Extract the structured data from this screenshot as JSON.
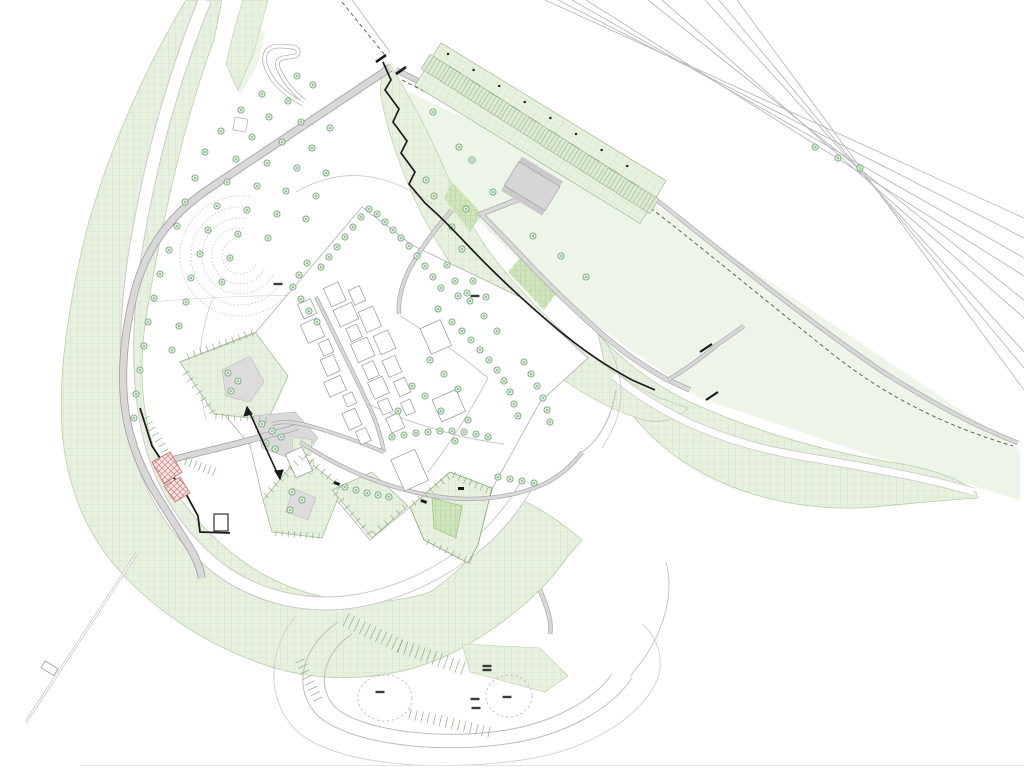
{
  "palette": {
    "band_fill": "#e8f1e0",
    "band_line": "#c7ddb4",
    "band_dense": "#cfe5bc",
    "band_dense_line": "#a2c98b",
    "flat_green": "#edf5e8",
    "road_fill": "#d8d8d8",
    "road_edge": "#9f9f9f",
    "rail_line": "#b9b9b9",
    "tree_stroke": "#6da377",
    "tree_fill": "#ddeed7",
    "tree_dot": "#4e8b5a",
    "wall_black": "#1c1c1c",
    "red_hatch": "#d08080",
    "label_ink": "#3a3a3a",
    "stall_fill": "#dcead2",
    "stall_line": "#8fb491"
  },
  "trees": [
    [
      297,
      76
    ],
    [
      313,
      85
    ],
    [
      262,
      94
    ],
    [
      288,
      101
    ],
    [
      241,
      110
    ],
    [
      269,
      117
    ],
    [
      301,
      122
    ],
    [
      330,
      128
    ],
    [
      221,
      131
    ],
    [
      252,
      137
    ],
    [
      282,
      142
    ],
    [
      312,
      148
    ],
    [
      205,
      152
    ],
    [
      236,
      159
    ],
    [
      267,
      163
    ],
    [
      297,
      168
    ],
    [
      326,
      173
    ],
    [
      195,
      178
    ],
    [
      227,
      182
    ],
    [
      257,
      186
    ],
    [
      286,
      191
    ],
    [
      316,
      196
    ],
    [
      185,
      202
    ],
    [
      217,
      206
    ],
    [
      247,
      210
    ],
    [
      277,
      214
    ],
    [
      306,
      219
    ],
    [
      177,
      226
    ],
    [
      208,
      230
    ],
    [
      238,
      234
    ],
    [
      268,
      238
    ],
    [
      169,
      250
    ],
    [
      200,
      254
    ],
    [
      230,
      258
    ],
    [
      160,
      274
    ],
    [
      191,
      278
    ],
    [
      222,
      282
    ],
    [
      154,
      298
    ],
    [
      186,
      302
    ],
    [
      148,
      322
    ],
    [
      179,
      326
    ],
    [
      144,
      346
    ],
    [
      172,
      350
    ],
    [
      140,
      370
    ],
    [
      136,
      394
    ],
    [
      134,
      418
    ],
    [
      321,
      267
    ],
    [
      329,
      257
    ],
    [
      337,
      247
    ],
    [
      345,
      237
    ],
    [
      353,
      227
    ],
    [
      361,
      217
    ],
    [
      369,
      209
    ],
    [
      377,
      214
    ],
    [
      385,
      222
    ],
    [
      393,
      230
    ],
    [
      401,
      238
    ],
    [
      409,
      246
    ],
    [
      417,
      256
    ],
    [
      425,
      266
    ],
    [
      433,
      277
    ],
    [
      441,
      288
    ],
    [
      307,
      263
    ],
    [
      299,
      275
    ],
    [
      293,
      287
    ],
    [
      301,
      299
    ],
    [
      309,
      311
    ],
    [
      317,
      322
    ],
    [
      472,
      160
    ],
    [
      493,
      192
    ],
    [
      466,
      209
    ],
    [
      452,
      227
    ],
    [
      462,
      249
    ],
    [
      447,
      265
    ],
    [
      473,
      281
    ],
    [
      486,
      297
    ],
    [
      458,
      296
    ],
    [
      438,
      309
    ],
    [
      426,
      180
    ],
    [
      434,
      196
    ],
    [
      452,
      322
    ],
    [
      462,
      331
    ],
    [
      471,
      340
    ],
    [
      480,
      350
    ],
    [
      489,
      360
    ],
    [
      497,
      370
    ],
    [
      504,
      381
    ],
    [
      510,
      392
    ],
    [
      514,
      404
    ],
    [
      518,
      416
    ],
    [
      524,
      362
    ],
    [
      531,
      374
    ],
    [
      537,
      386
    ],
    [
      543,
      398
    ],
    [
      547,
      410
    ],
    [
      550,
      422
    ],
    [
      392,
      437
    ],
    [
      404,
      435
    ],
    [
      416,
      433
    ],
    [
      428,
      432
    ],
    [
      440,
      431
    ],
    [
      452,
      431
    ],
    [
      464,
      432
    ],
    [
      476,
      434
    ],
    [
      488,
      437
    ],
    [
      345,
      487
    ],
    [
      356,
      490
    ],
    [
      367,
      493
    ],
    [
      378,
      495
    ],
    [
      389,
      497
    ],
    [
      498,
      477
    ],
    [
      510,
      479
    ],
    [
      522,
      481
    ],
    [
      534,
      483
    ],
    [
      430,
      360
    ],
    [
      444,
      374
    ],
    [
      458,
      389
    ],
    [
      425,
      396
    ],
    [
      441,
      411
    ],
    [
      468,
      420
    ],
    [
      455,
      441
    ],
    [
      412,
      386
    ],
    [
      398,
      411
    ],
    [
      470,
      301
    ],
    [
      484,
      316
    ],
    [
      497,
      331
    ],
    [
      455,
      281
    ],
    [
      467,
      293
    ],
    [
      533,
      236
    ],
    [
      561,
      256
    ],
    [
      586,
      277
    ],
    [
      815,
      147
    ],
    [
      838,
      158
    ],
    [
      860,
      168
    ],
    [
      262,
      424
    ],
    [
      272,
      431
    ],
    [
      281,
      437
    ],
    [
      266,
      443
    ],
    [
      275,
      449
    ],
    [
      228,
      373
    ],
    [
      238,
      381
    ],
    [
      231,
      391
    ],
    [
      292,
      492
    ],
    [
      302,
      500
    ],
    [
      290,
      510
    ],
    [
      433,
      112
    ],
    [
      459,
      147
    ]
  ],
  "parking_lot": {
    "bay_count": 11,
    "origin": [
      441,
      71
    ],
    "step": [
      19.8,
      12.6
    ],
    "bay_w": 36,
    "bay_h": 17,
    "angle": 31.5,
    "stalls_per_bay": 8,
    "post_count": 8,
    "post_origin": [
      448,
      54
    ],
    "post_step": [
      25.6,
      16
    ]
  },
  "buildings": {
    "cx": 350,
    "cy": 373,
    "angle": 66,
    "rects": [
      [
        -88,
        -26,
        20,
        16
      ],
      [
        -64,
        -30,
        18,
        20
      ],
      [
        -42,
        -26,
        14,
        12
      ],
      [
        -26,
        -30,
        20,
        18
      ],
      [
        -2,
        -26,
        16,
        12
      ],
      [
        16,
        -28,
        18,
        16
      ],
      [
        38,
        -24,
        14,
        11
      ],
      [
        56,
        -28,
        16,
        14
      ],
      [
        -84,
        6,
        16,
        14
      ],
      [
        -64,
        8,
        20,
        18
      ],
      [
        -40,
        6,
        14,
        11
      ],
      [
        -24,
        8,
        18,
        14
      ],
      [
        -2,
        10,
        16,
        18
      ],
      [
        18,
        6,
        12,
        10
      ],
      [
        34,
        10,
        18,
        14
      ],
      [
        56,
        8,
        14,
        11
      ],
      [
        -52,
        -48,
        22,
        16
      ],
      [
        -24,
        -52,
        20,
        16
      ],
      [
        2,
        -48,
        18,
        14
      ],
      [
        -76,
        -44,
        16,
        12
      ],
      [
        26,
        -48,
        16,
        12
      ],
      [
        48,
        -44,
        14,
        10
      ],
      [
        -12,
        -104,
        28,
        22
      ],
      [
        58,
        -90,
        24,
        26
      ],
      [
        96,
        -28,
        34,
        26
      ],
      [
        48,
        74,
        26,
        18
      ]
    ]
  },
  "tick_rows": [
    [
      188,
      356,
      252,
      333,
      7,
      10
    ],
    [
      186,
      373,
      212,
      412,
      7,
      6
    ],
    [
      216,
      416,
      266,
      420,
      6,
      8
    ],
    [
      266,
      495,
      301,
      458,
      7,
      7
    ],
    [
      306,
      456,
      340,
      487,
      7,
      6
    ],
    [
      276,
      533,
      319,
      536,
      6,
      7
    ],
    [
      336,
      494,
      369,
      533,
      6,
      6
    ],
    [
      374,
      533,
      404,
      507,
      6,
      5
    ],
    [
      414,
      503,
      448,
      477,
      7,
      6
    ],
    [
      454,
      475,
      487,
      490,
      7,
      6
    ],
    [
      428,
      542,
      465,
      559,
      6,
      6
    ],
    [
      146,
      418,
      168,
      456,
      8,
      7
    ],
    [
      186,
      461,
      214,
      472,
      9,
      6
    ],
    [
      346,
      620,
      400,
      646,
      14,
      10
    ],
    [
      400,
      646,
      463,
      668,
      14,
      11
    ],
    [
      410,
      714,
      489,
      732,
      11,
      13
    ],
    [
      300,
      661,
      318,
      699,
      10,
      7
    ]
  ],
  "labels": [
    [
      278,
      284
    ],
    [
      475,
      296
    ],
    [
      487,
      666
    ],
    [
      487,
      670
    ],
    [
      380,
      692
    ],
    [
      475,
      699
    ],
    [
      476,
      708
    ],
    [
      507,
      697
    ]
  ],
  "contours": {
    "cx": 240,
    "cy": 256,
    "radii": [
      18,
      28,
      38,
      49,
      60
    ],
    "a1": 30,
    "a2": 280
  },
  "dashed_circles": [
    [
      385,
      698,
      27,
      23
    ],
    [
      509,
      696,
      23,
      21
    ]
  ]
}
